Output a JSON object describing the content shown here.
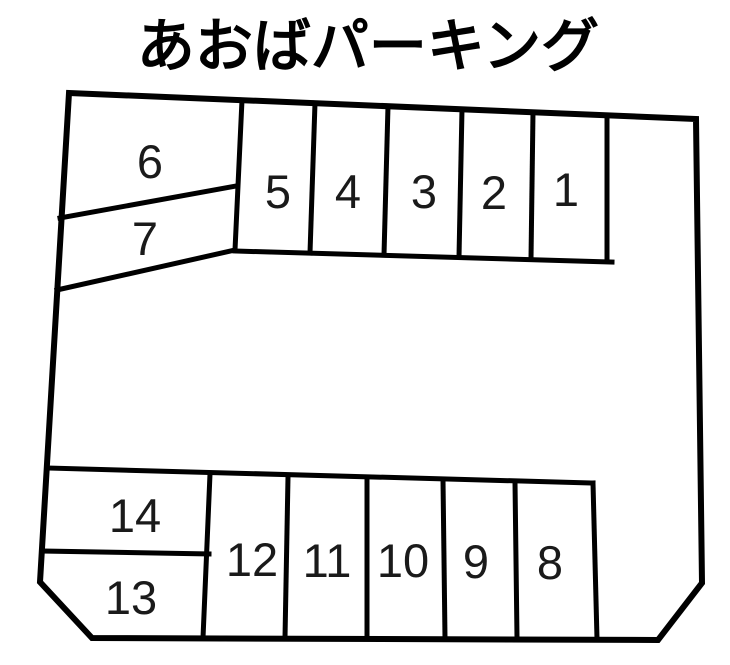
{
  "title": "あおばパーキング",
  "colors": {
    "line": "#000000",
    "background": "#ffffff",
    "text": "#1a1a1a"
  },
  "parking": {
    "spaces": [
      {
        "number": "1"
      },
      {
        "number": "2"
      },
      {
        "number": "3"
      },
      {
        "number": "4"
      },
      {
        "number": "5"
      },
      {
        "number": "6"
      },
      {
        "number": "7"
      },
      {
        "number": "8"
      },
      {
        "number": "9"
      },
      {
        "number": "10"
      },
      {
        "number": "11"
      },
      {
        "number": "12"
      },
      {
        "number": "13"
      },
      {
        "number": "14"
      }
    ]
  }
}
